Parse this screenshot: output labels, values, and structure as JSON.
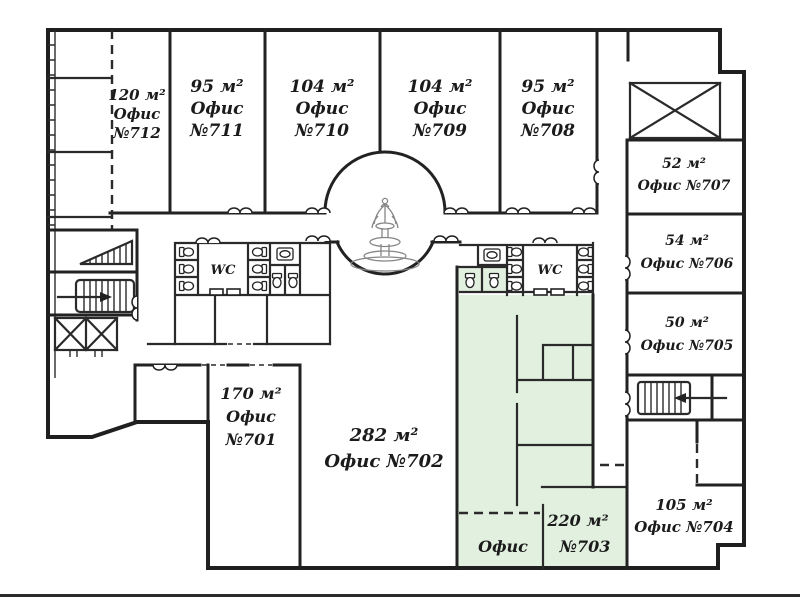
{
  "plan": {
    "wc_label": "WC",
    "colors": {
      "wall": "#1f1f1f",
      "highlight_green": "#e2f1df",
      "background": "#ffffff"
    },
    "offices": {
      "o712": {
        "area": "120 м²",
        "name": "Офис",
        "num": "№712"
      },
      "o711": {
        "area": "95 м²",
        "name": "Офис",
        "num": "№711"
      },
      "o710": {
        "area": "104 м²",
        "name": "Офис",
        "num": "№710"
      },
      "o709": {
        "area": "104 м²",
        "name": "Офис",
        "num": "№709"
      },
      "o708": {
        "area": "95 м²",
        "name": "Офис",
        "num": "№708"
      },
      "o707": {
        "area": "52 м²",
        "name": "Офис №707"
      },
      "o706": {
        "area": "54 м²",
        "name": "Офис №706"
      },
      "o705": {
        "area": "50 м²",
        "name": "Офис №705"
      },
      "o704": {
        "area": "105 м²",
        "name": "Офис №704"
      },
      "o701": {
        "area": "170 м²",
        "name": "Офис",
        "num": "№701"
      },
      "o702": {
        "area": "282 м²",
        "name": "Офис №702"
      },
      "o703": {
        "area": "220 м²",
        "name": "Офис",
        "num": "№703"
      }
    }
  }
}
